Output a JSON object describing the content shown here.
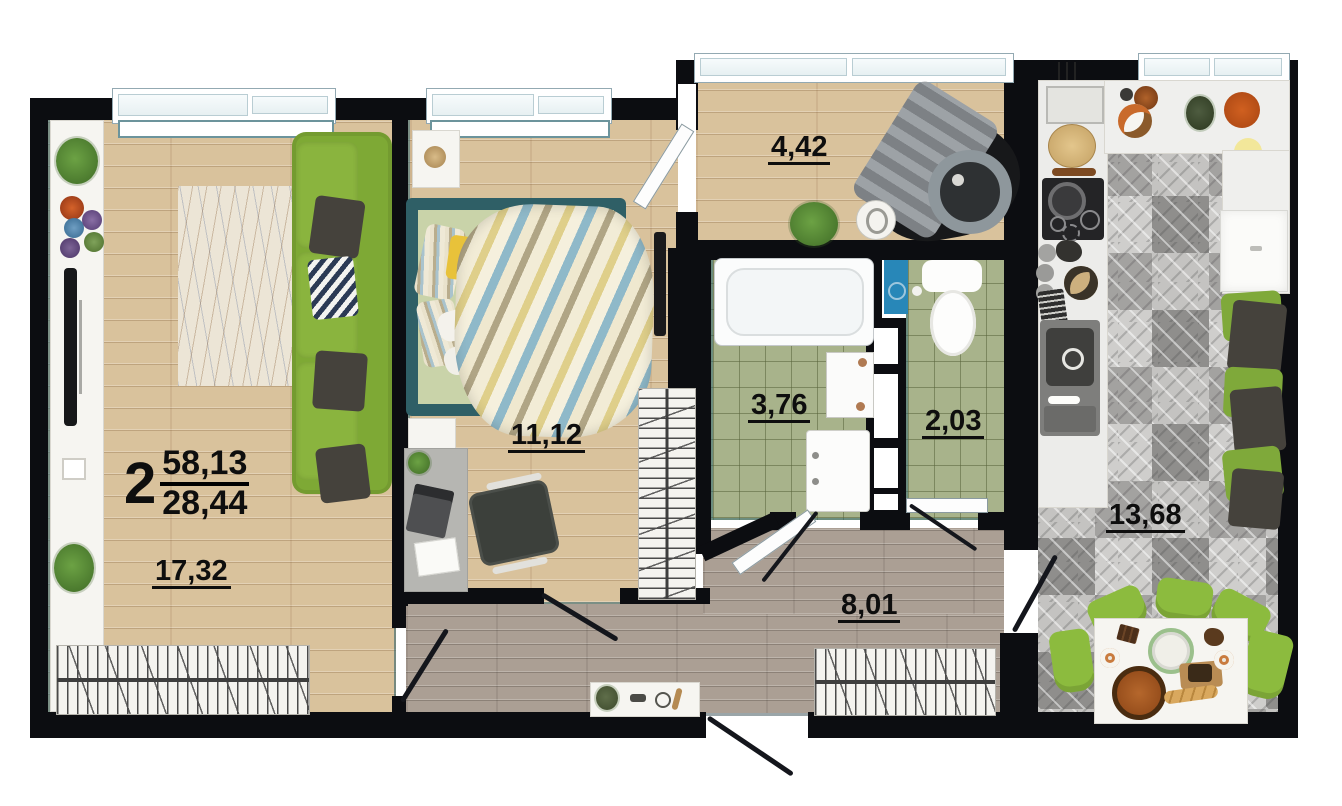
{
  "plan": {
    "type_number": "2",
    "total_area": "58,13",
    "living_area": "28,44",
    "areas": {
      "living_room": "17,32",
      "bedroom": "11,12",
      "balcony": "4,42",
      "bathroom": "3,76",
      "wc": "2,03",
      "hallway": "8,01",
      "kitchen": "13,68"
    },
    "colors": {
      "wall": "#0c0d11",
      "accent_teal": "#2e6672",
      "wood_floor": "#d9c29c",
      "hall_floor": "#ab9f94",
      "bath_tile": "#a8b38b",
      "kitchen_tile": "#b7b6b4",
      "sofa_green": "#7ea935",
      "chair_green": "#8cbb3e",
      "bed_frame_teal": "#2f5f66",
      "cabinet_blue": "#2887b8",
      "bowl_orange": "#d06020"
    }
  }
}
